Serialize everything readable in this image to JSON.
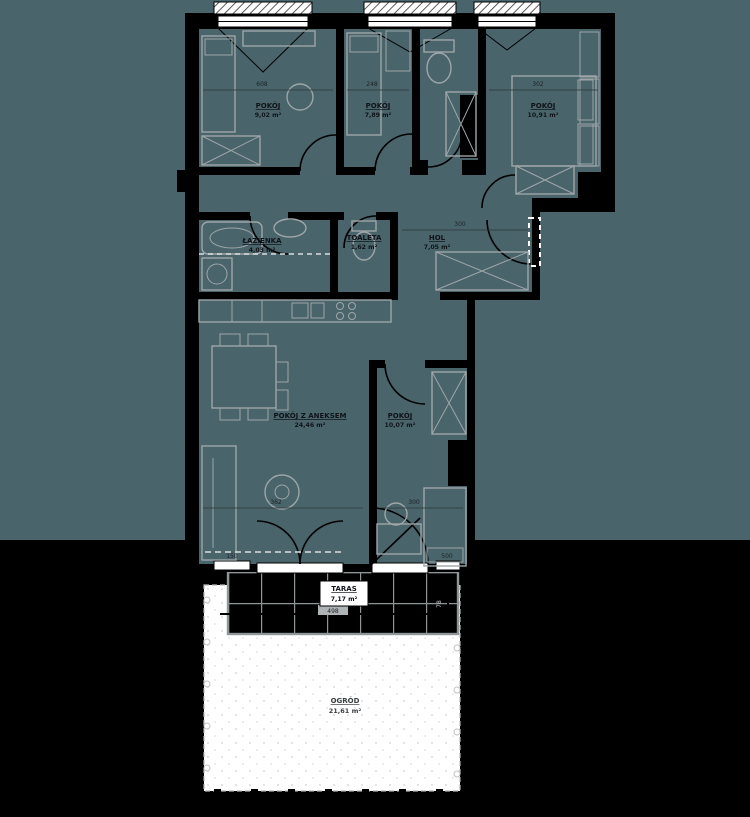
{
  "page": {
    "bg_upper": "#4a646c",
    "bg_lower": "#000000",
    "wall_color": "#000000",
    "furniture_color": "#9ea6a8"
  },
  "rooms": [
    {
      "name": "POKÓJ",
      "area": "9,02 m²"
    },
    {
      "name": "POKÓJ",
      "area": "7,89 m²"
    },
    {
      "name": "POKÓJ",
      "area": "10,91 m²"
    },
    {
      "name": "ŁAZIENKA",
      "area": "4,03 m²"
    },
    {
      "name": "TOALETA",
      "area": "1,62 m²"
    },
    {
      "name": "HOL",
      "area": "7,05 m²"
    },
    {
      "name": "POKÓJ Z ANEKSEM",
      "area": "24,46 m²"
    },
    {
      "name": "POKÓJ",
      "area": "10,07 m²"
    },
    {
      "name": "TARAS",
      "area": "7,17 m²"
    },
    {
      "name": "OGRÓD",
      "area": "21,61 m²"
    }
  ],
  "dimensions": {
    "room1_width": "608",
    "room2_width": "248",
    "room3_width": "302",
    "hall_width": "300",
    "living_width": "362",
    "room4_width": "300",
    "terrace_width": "498",
    "terrace_depth": "78",
    "sofa_len": "150",
    "bed_len": "500"
  }
}
